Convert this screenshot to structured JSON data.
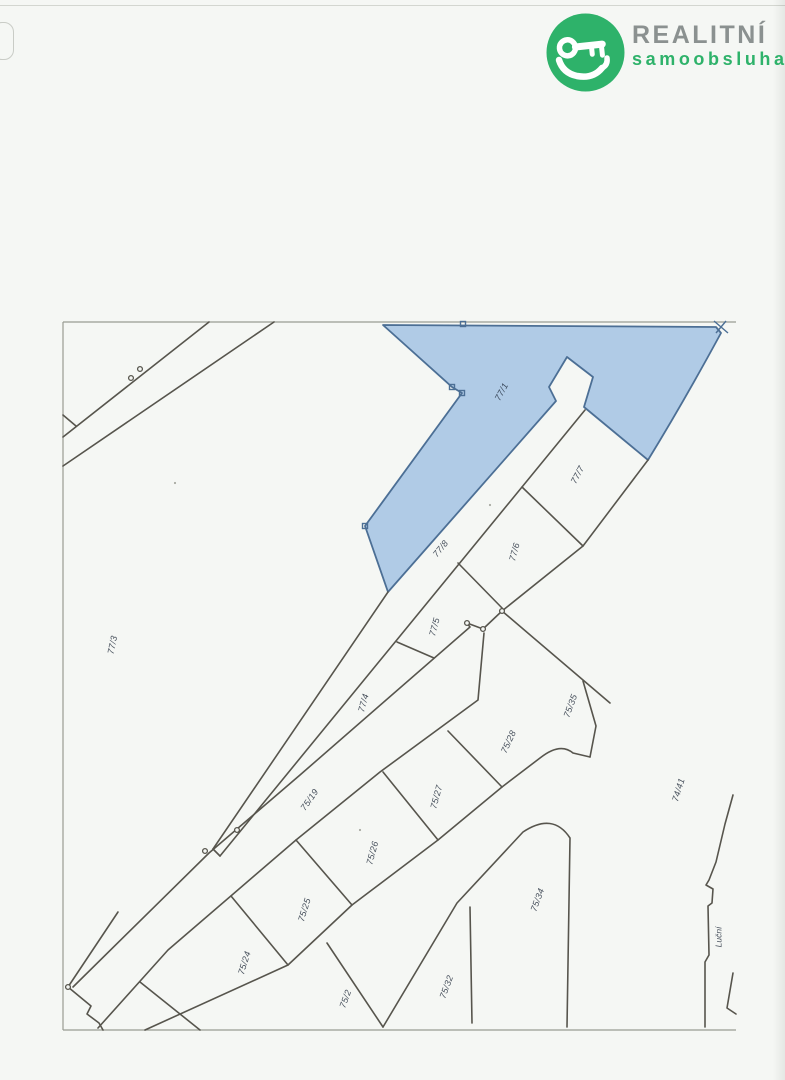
{
  "logo": {
    "title": "REALITNÍ",
    "subtitle": "samoobsluha",
    "accent_color": "#2eb26a",
    "title_color": "#8b9190",
    "icon": "hand-holding-key-icon"
  },
  "map": {
    "type": "cadastral-parcel-map",
    "line_color": "#57554d",
    "border_color": "#999b92",
    "label_color": "#47505c",
    "highlighted_parcel": {
      "label": "77/1",
      "fill": "#b0cbe6",
      "stroke": "#4c6f95",
      "label_color": "#3f4e61"
    },
    "street_label": {
      "text": "Luční",
      "x": 719,
      "y": 937,
      "rot": -90
    },
    "parcels": [
      {
        "label": "77/1",
        "x": 502,
        "y": 392,
        "rot": -62,
        "highlighted": true
      },
      {
        "label": "77/7",
        "x": 578,
        "y": 475,
        "rot": -62
      },
      {
        "label": "77/6",
        "x": 515,
        "y": 552,
        "rot": -75
      },
      {
        "label": "77/8",
        "x": 441,
        "y": 549,
        "rot": -51
      },
      {
        "label": "77/5",
        "x": 435,
        "y": 627,
        "rot": -75
      },
      {
        "label": "77/4",
        "x": 364,
        "y": 703,
        "rot": -75
      },
      {
        "label": "77/3",
        "x": 113,
        "y": 645,
        "rot": -78
      },
      {
        "label": "75/19",
        "x": 310,
        "y": 800,
        "rot": -55
      },
      {
        "label": "75/35",
        "x": 571,
        "y": 706,
        "rot": -70
      },
      {
        "label": "75/28",
        "x": 509,
        "y": 742,
        "rot": -65
      },
      {
        "label": "75/27",
        "x": 437,
        "y": 797,
        "rot": -75
      },
      {
        "label": "75/26",
        "x": 373,
        "y": 853,
        "rot": -75
      },
      {
        "label": "75/25",
        "x": 305,
        "y": 910,
        "rot": -73
      },
      {
        "label": "75/24",
        "x": 245,
        "y": 963,
        "rot": -73
      },
      {
        "label": "75/2",
        "x": 346,
        "y": 999,
        "rot": -70
      },
      {
        "label": "75/32",
        "x": 447,
        "y": 987,
        "rot": -70
      },
      {
        "label": "75/34",
        "x": 538,
        "y": 900,
        "rot": -70
      },
      {
        "label": "74/41",
        "x": 679,
        "y": 790,
        "rot": -73
      }
    ]
  }
}
